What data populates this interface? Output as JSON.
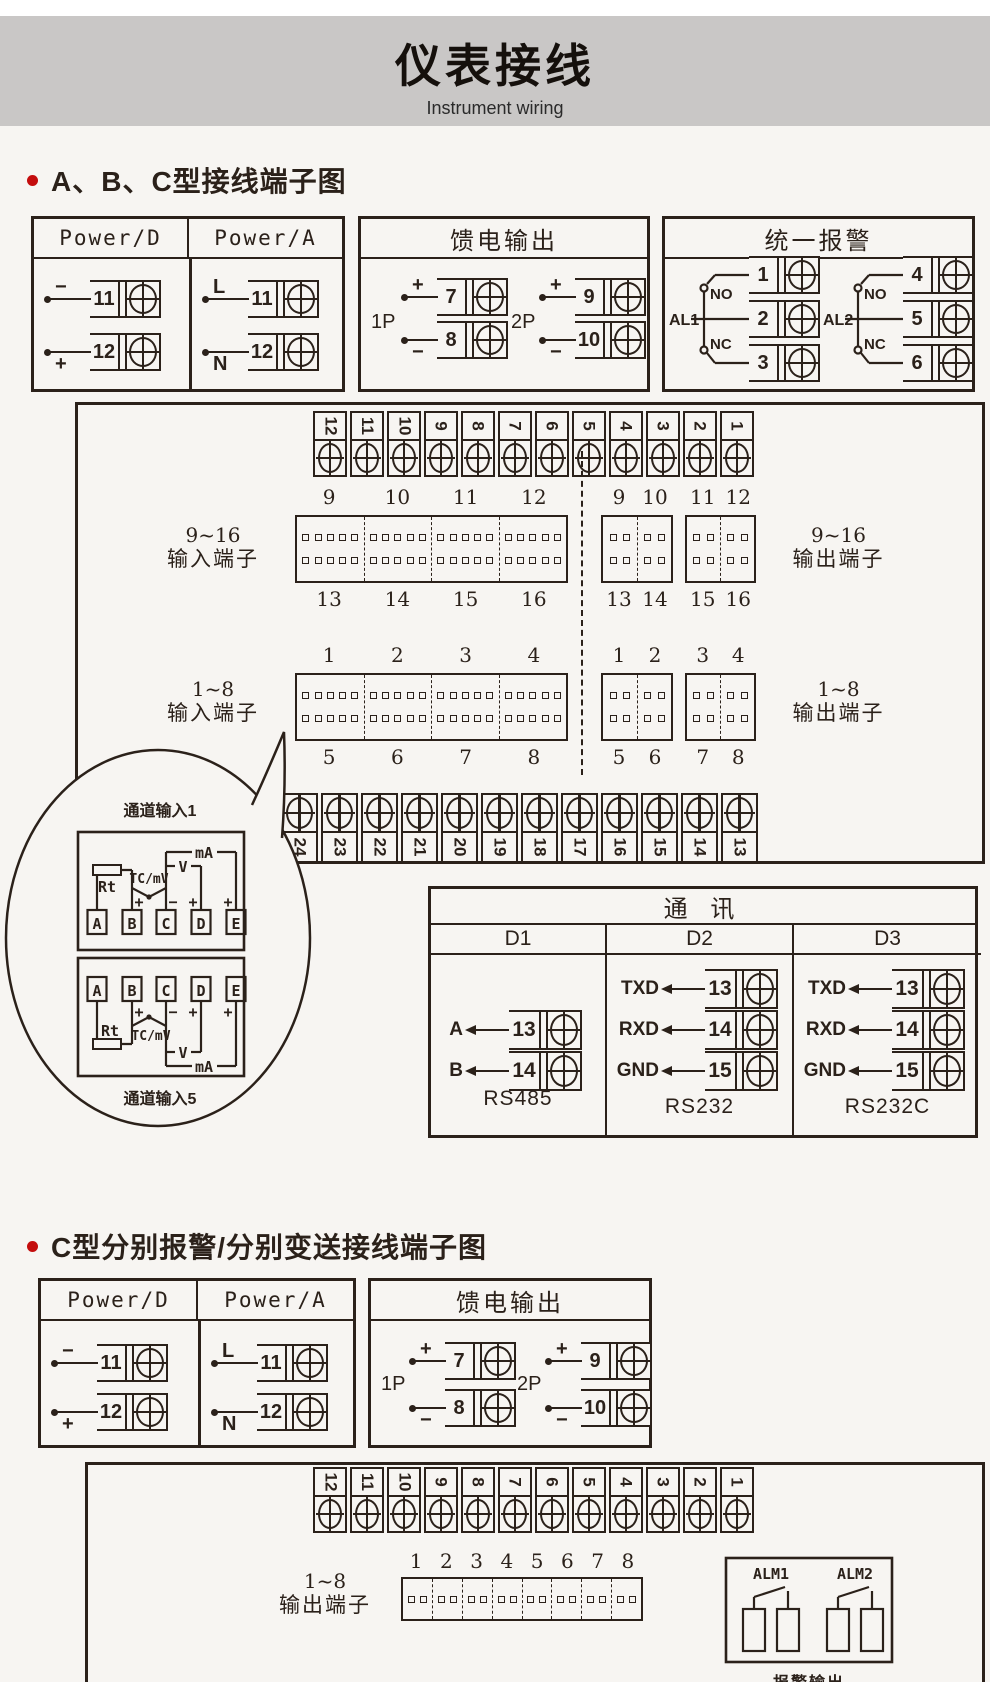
{
  "header": {
    "title": "仪表接线",
    "subtitle": "Instrument wiring"
  },
  "sections": {
    "s1": "A、B、C型接线端子图",
    "s2": "C型分别报警/分别变送接线端子图"
  },
  "power_box": {
    "headers": [
      "Power/D",
      "Power/A"
    ],
    "columns": [
      {
        "rows": [
          {
            "sign": "−",
            "num": "11"
          },
          {
            "sign": "+",
            "num": "12"
          }
        ]
      },
      {
        "rows": [
          {
            "sign": "L",
            "num": "11"
          },
          {
            "sign": "N",
            "num": "12"
          }
        ]
      }
    ]
  },
  "feed_box": {
    "title": "馈电输出",
    "groups": [
      {
        "label": "1P",
        "rows": [
          {
            "sign": "+",
            "num": "7"
          },
          {
            "sign": "−",
            "num": "8"
          }
        ]
      },
      {
        "label": "2P",
        "rows": [
          {
            "sign": "+",
            "num": "9"
          },
          {
            "sign": "−",
            "num": "10"
          }
        ]
      }
    ]
  },
  "alarm_box": {
    "title": "统一报警",
    "groups": [
      {
        "label": "AL1",
        "no": "NO",
        "nc": "NC",
        "nums": [
          "1",
          "2",
          "3"
        ]
      },
      {
        "label": "AL2",
        "no": "NO",
        "nc": "NC",
        "nums": [
          "4",
          "5",
          "6"
        ]
      }
    ]
  },
  "main_board": {
    "top_strip": [
      "12",
      "11",
      "10",
      "9",
      "8",
      "7",
      "6",
      "5",
      "4",
      "3",
      "2",
      "1"
    ],
    "bottom_strip": [
      "24",
      "23",
      "22",
      "21",
      "20",
      "19",
      "18",
      "17",
      "16",
      "15",
      "14",
      "13"
    ],
    "rows": [
      {
        "in_label1": "9~16",
        "in_label2": "输入端子",
        "in_top": [
          "9",
          "10",
          "11",
          "12"
        ],
        "in_bottom": [
          "13",
          "14",
          "15",
          "16"
        ],
        "out_top": [
          [
            "9",
            "10"
          ],
          [
            "11",
            "12"
          ]
        ],
        "out_bottom": [
          [
            "13",
            "14"
          ],
          [
            "15",
            "16"
          ]
        ],
        "out_label1": "9~16",
        "out_label2": "输出端子"
      },
      {
        "in_label1": "1~8",
        "in_label2": "输入端子",
        "in_top": [
          "1",
          "2",
          "3",
          "4"
        ],
        "in_bottom": [
          "5",
          "6",
          "7",
          "8"
        ],
        "out_top": [
          [
            "1",
            "2"
          ],
          [
            "3",
            "4"
          ]
        ],
        "out_bottom": [
          [
            "5",
            "6"
          ],
          [
            "7",
            "8"
          ]
        ],
        "out_label1": "1~8",
        "out_label2": "输出端子"
      }
    ]
  },
  "balloon": {
    "top_label": "通道输入1",
    "bottom_label": "通道输入5",
    "terminals": [
      "A",
      "B",
      "C",
      "D",
      "E"
    ],
    "rt": "Rt",
    "tc": "TC/mV",
    "v": "V",
    "ma": "mA",
    "signs": [
      "+",
      "−",
      "+",
      "+"
    ]
  },
  "comm_box": {
    "title": "通  讯",
    "columns": [
      {
        "header": "D1",
        "rows": [
          {
            "signal": "A",
            "num": "13"
          },
          {
            "signal": "B",
            "num": "14"
          }
        ],
        "label": "RS485"
      },
      {
        "header": "D2",
        "rows": [
          {
            "signal": "TXD",
            "num": "13"
          },
          {
            "signal": "RXD",
            "num": "14"
          },
          {
            "signal": "GND",
            "num": "15"
          }
        ],
        "label": "RS232"
      },
      {
        "header": "D3",
        "rows": [
          {
            "signal": "TXD",
            "num": "13"
          },
          {
            "signal": "RXD",
            "num": "14"
          },
          {
            "signal": "GND",
            "num": "15"
          }
        ],
        "label": "RS232C"
      }
    ]
  },
  "bottom_board": {
    "strip": [
      "12",
      "11",
      "10",
      "9",
      "8",
      "7",
      "6",
      "5",
      "4",
      "3",
      "2",
      "1"
    ],
    "out_label1": "1~8",
    "out_label2": "输出端子",
    "out_nums": [
      "1",
      "2",
      "3",
      "4",
      "5",
      "6",
      "7",
      "8"
    ],
    "alarm_out": {
      "labels": [
        "ALM1",
        "ALM2"
      ],
      "caption": "报警输出"
    }
  }
}
